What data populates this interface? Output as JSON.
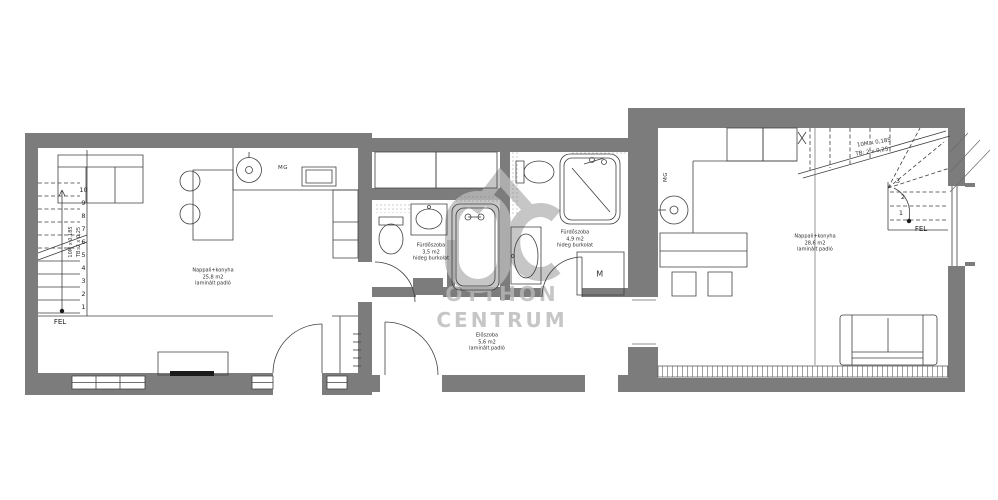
{
  "watermark": {
    "line1": "OTTHON",
    "line2": "CENTRUM",
    "logo": "OC house logo"
  },
  "units": {
    "left": {
      "living": {
        "name": "Nappali+konyha",
        "area": "25,8 m2",
        "floor": "laminált padló"
      },
      "stairs": {
        "direction_label": "FEL",
        "notation_line1": "10M x 0,185",
        "notation_line2": "TB: 2 x 0,25",
        "step_numbers": [
          "1",
          "2",
          "3",
          "4",
          "5",
          "6",
          "7",
          "8",
          "9",
          "10"
        ]
      },
      "appliances": {
        "dishwasher": "MG"
      }
    },
    "middle": {
      "bathroom_left": {
        "name": "Fürdőszoba",
        "area": "3,5 m2",
        "floor": "hideg burkolat"
      },
      "bathroom_right": {
        "name": "Fürdőszoba",
        "area": "4,9 m2",
        "floor": "hideg burkolat"
      },
      "hall": {
        "name": "Előszoba",
        "area": "5,6 m2",
        "floor": "laminált padló"
      },
      "appliances": {
        "washing_machine": "M"
      }
    },
    "right": {
      "living": {
        "name": "Nappali+konyha",
        "area": "28,6 m2",
        "floor": "laminált padló"
      },
      "stairs": {
        "direction_label": "FEL",
        "notation_line1": "10M x 0,185",
        "notation_line2": "TB: 2 x 0,25",
        "step_numbers": [
          "1",
          "2",
          "3"
        ]
      },
      "appliances": {
        "dishwasher": "MG"
      }
    }
  },
  "colors": {
    "wall": "#7c7c7c",
    "line": "#3f3f3f",
    "watermark": "#b9b9b9",
    "background": "#ffffff"
  }
}
